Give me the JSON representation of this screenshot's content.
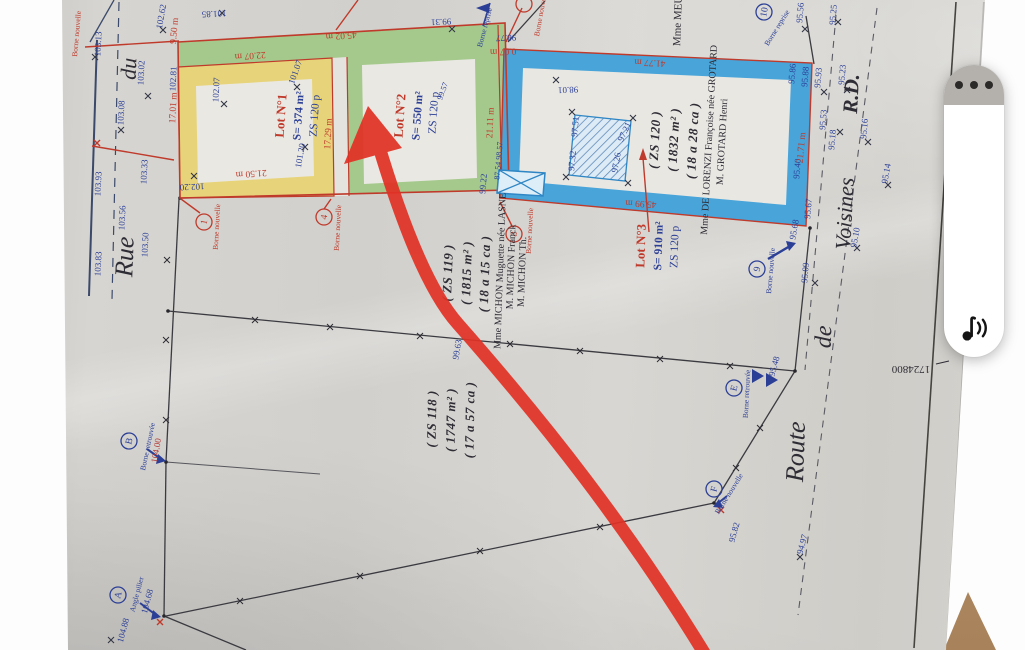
{
  "app": {
    "toolbar": {
      "menu_button_label": "more options",
      "audio_button_label": "read aloud"
    }
  },
  "plan": {
    "streets": {
      "rue": "Rue",
      "du": "du",
      "route": "Route",
      "de": "de",
      "voisines": "Voisines",
      "rd": "R.D."
    },
    "lots": [
      {
        "name": "Lot N°1",
        "area": "S= 374 m²",
        "zoning": "ZS 120 p",
        "ring_color": "#e7d47a"
      },
      {
        "name": "Lot N°2",
        "area": "S= 550 m²",
        "zoning": "ZS 120 p",
        "ring_color": "#a5c98c"
      },
      {
        "name": "Lot N°3",
        "area": "S= 910 m²",
        "zoning": "ZS 120 p",
        "ring_color": "#48a4d9"
      }
    ],
    "parcels": [
      {
        "ref": "( ZS 119 )",
        "area_m2": "( 1815 m² )",
        "area_a_ca": "( 18 a 15 ca )",
        "owners": [
          "Mme MICHON Muguette née LASNE",
          "M. MICHON Franck",
          "M. MICHON Th."
        ]
      },
      {
        "ref": "( ZS 118 )",
        "area_m2": "( 1747 m² )",
        "area_a_ca": "( 17 a 57 ca )",
        "owners": []
      },
      {
        "ref": "( ZS 120 )",
        "area_m2": "( 1832 m² )",
        "area_a_ca": "( 18 a 28 ca )",
        "owners": [
          "Mme DE LORENZI Françoise née GROTARD",
          "M. GROTARD Henri"
        ]
      }
    ],
    "neighbor_label": "Mme MEU",
    "coordinate_label": "1724800",
    "measurements": [
      "9.50 m",
      "22.07 m",
      "45.02 m",
      "17.01 m",
      "21.50 m",
      "17.29 m",
      "0.07 m",
      "21.11 m",
      "41.77 m",
      "45.99 m",
      "21.71 m"
    ],
    "elevations": [
      "103.13",
      "103.08",
      "103.02",
      "102.62",
      "101.85",
      "103.93",
      "103.33",
      "103.56",
      "103.50",
      "103.83",
      "102.81",
      "102.07",
      "101.07",
      "101.20",
      "102.20",
      "99.31",
      "98.77",
      "99.57",
      "98.01",
      "97.51",
      "97.32",
      "97.21",
      "97.26",
      "87.54 98.57",
      "95.86",
      "95.56",
      "95.25",
      "95.88",
      "95.93",
      "95.23",
      "95.53",
      "95.18",
      "95.16",
      "95.14",
      "95.40",
      "95.67",
      "95.68",
      "95.10",
      "95.09",
      "99.63",
      "95.48",
      "95.82",
      "94.97",
      "104.00",
      "104.68",
      "104.88",
      "99.22"
    ],
    "bornes": {
      "b1": "1",
      "b4": "4",
      "b8": "8",
      "b9": "9",
      "b10": "10",
      "bA": "A",
      "bB": "B",
      "bE": "E",
      "bF": "F"
    },
    "borne_notes": {
      "nouvelle": "Borne nouvelle",
      "reprise": "Borne reprise",
      "retrouvee": "Borne retrouvée",
      "angle": "Angle pilier"
    }
  }
}
